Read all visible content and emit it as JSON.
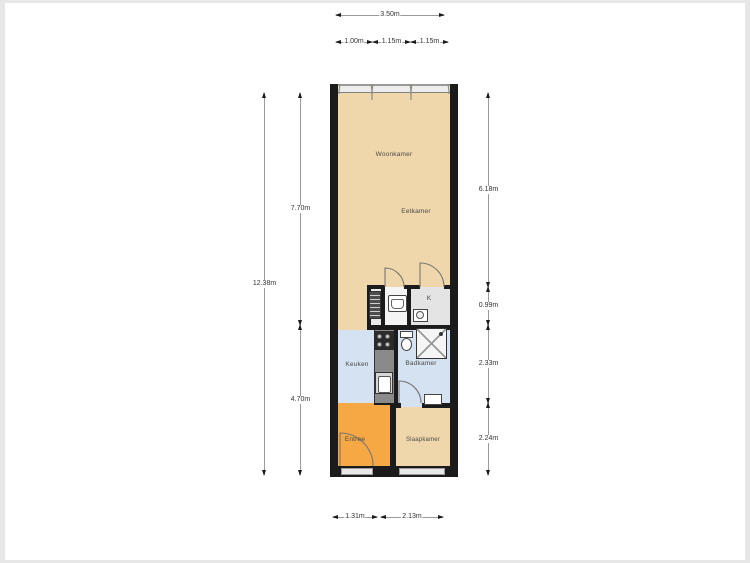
{
  "title": "Floor plan (plattegrond)",
  "plan": {
    "rooms": {
      "woonkamer": {
        "label": "Woonkamer"
      },
      "eetkamer": {
        "label": "Eetkamer"
      },
      "keuken": {
        "label": "Keuken"
      },
      "badkamer": {
        "label": "Badkamer"
      },
      "entree": {
        "label": "Entree"
      },
      "slaapkamer": {
        "label": "Slaapkamer"
      },
      "kast": {
        "label": "K"
      }
    },
    "fixtures": [
      "boiler-icon",
      "washbasin-icon",
      "washer-icon",
      "stove-icon",
      "kitchen-sink-icon",
      "toilet-icon",
      "shower-icon",
      "bathroom-sink-icon",
      "door-swing-arc",
      "window-swing-arc"
    ]
  },
  "dims": {
    "top_total": "3.50m",
    "top_segments": [
      "1.00m",
      "1.15m",
      "1.15m"
    ],
    "left_total": "12.38m",
    "left_upper": "7.70m",
    "left_lower": "4.70m",
    "right": [
      "6.18m",
      "0.99m",
      "2.33m",
      "2.24m"
    ],
    "bottom": [
      "1.31m",
      "2.13m"
    ]
  },
  "colors": {
    "wall": "#1b1b1b",
    "floor_main": "#f0d7ab",
    "floor_wet": "#d5e2f1",
    "floor_entree": "#f5a844",
    "window_band": "#ececec",
    "dim_line": "#9a9a9a",
    "dim_text": "#333333"
  }
}
